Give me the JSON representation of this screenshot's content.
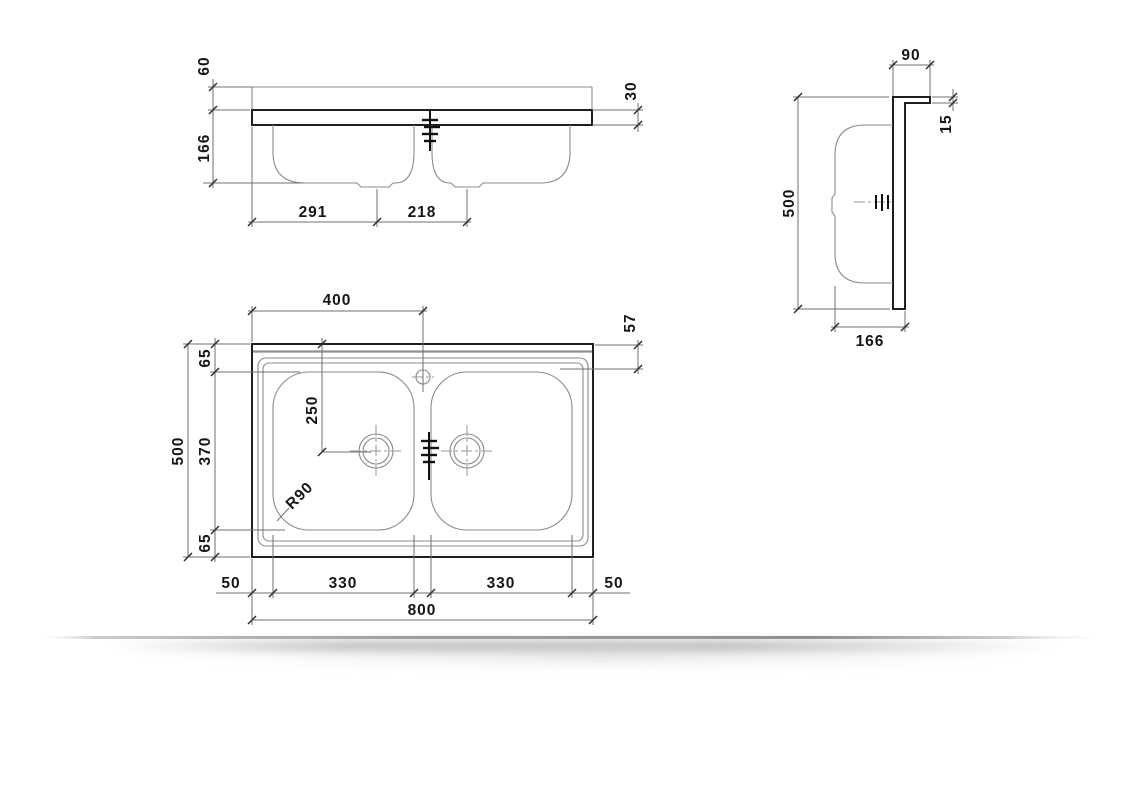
{
  "drawing_title": "double-bowl-sit-on-sink-technical-drawing",
  "colors": {
    "outline": "#1f1f1f",
    "thin_line": "#8b8b8b",
    "dimension_line": "#6f6f6f",
    "text": "#161616",
    "shadow": "#8f8f8f",
    "background": "#ffffff"
  },
  "front_view": {
    "upstand_height": "60",
    "bowl_depth": "166",
    "rim_thickness": "30",
    "drain_left_offset": "291",
    "drain_spacing": "218"
  },
  "side_view": {
    "back_edge_height": "90",
    "upstand_thickness": "15",
    "overall_depth": "500",
    "section_depth": "166"
  },
  "plan_view": {
    "tap_hole_offset": "400",
    "back_to_drainer_edge": "57",
    "back_margin": "65",
    "drain_from_back": "250",
    "bowl_front_to_back": "370",
    "overall_depth": "500",
    "front_margin": "65",
    "corner_radius": "R90",
    "left_margin": "50",
    "left_bowl_width": "330",
    "right_bowl_width": "330",
    "right_margin": "50",
    "overall_width": "800"
  }
}
